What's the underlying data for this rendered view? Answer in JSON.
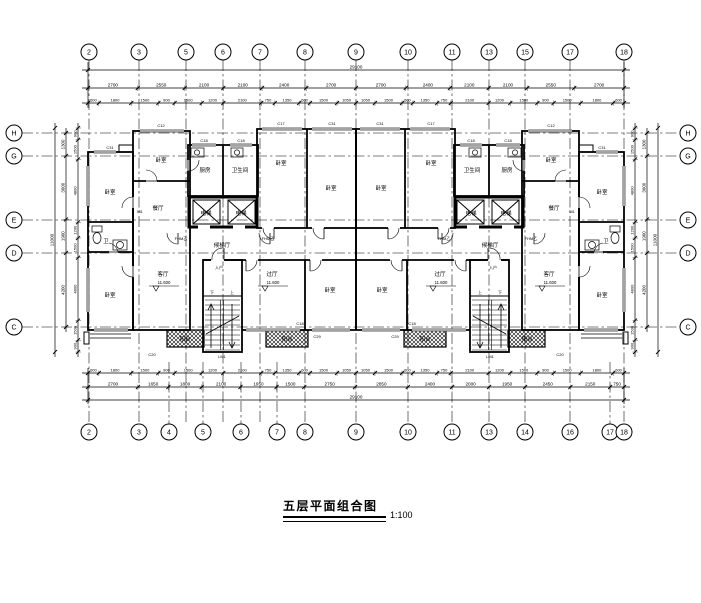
{
  "title": {
    "text": "五层平面组合图",
    "scale": "1:100"
  },
  "grids": {
    "top": {
      "y": 52,
      "x": [
        89,
        139,
        186,
        223,
        260,
        305,
        356,
        408,
        452,
        489,
        525,
        570,
        624
      ],
      "labels": [
        "2",
        "3",
        "5",
        "6",
        "7",
        "8",
        "9",
        "10",
        "11",
        "13",
        "15",
        "17",
        "18"
      ]
    },
    "bottom": {
      "y": 432,
      "x": [
        89,
        139,
        169,
        203,
        241,
        277,
        305,
        356,
        408,
        452,
        489,
        525,
        570,
        610,
        624
      ],
      "labels": [
        "2",
        "3",
        "4",
        "5",
        "6",
        "7",
        "8",
        "9",
        "10",
        "11",
        "13",
        "14",
        "16",
        "17",
        "18"
      ]
    },
    "left": {
      "x": 14,
      "y": [
        133,
        156,
        220,
        253,
        327
      ],
      "labels": [
        "H",
        "G",
        "E",
        "D",
        "C"
      ]
    },
    "right": {
      "x": 688,
      "y": [
        133,
        156,
        220,
        253,
        327
      ],
      "labels": [
        "H",
        "G",
        "E",
        "D",
        "C"
      ]
    }
  },
  "dimensions": {
    "top": {
      "overall": "29100",
      "axis": [
        "2700",
        "2550",
        "2100",
        "2100",
        "2400",
        "2700",
        "2700",
        "2400",
        "2100",
        "2100",
        "2550",
        "2700"
      ],
      "detail": [
        "600",
        "1800",
        "1500",
        "900",
        "1500",
        "1200",
        "2100",
        "750",
        "1350",
        "600",
        "1500",
        "1050",
        "1050",
        "1500",
        "600",
        "1350",
        "750",
        "2100",
        "1200",
        "1500",
        "900",
        "1500",
        "1800",
        "600"
      ]
    },
    "bottom": {
      "overall": "29100",
      "axis": [
        "2700",
        "1650",
        "1800",
        "2100",
        "1950",
        "1500",
        "2750",
        "2850",
        "2400",
        "2000",
        "1950",
        "2450",
        "2150",
        "750"
      ],
      "detail": [
        "600",
        "1800",
        "1500",
        "900",
        "1500",
        "1200",
        "2100",
        "750",
        "1350",
        "600",
        "1500",
        "1050",
        "1050",
        "1500",
        "600",
        "1350",
        "750",
        "2100",
        "1200",
        "1500",
        "900",
        "1500",
        "1800",
        "600"
      ]
    },
    "left": {
      "overall": "11000",
      "axis": [
        "1300",
        "3600",
        "1900",
        "4200"
      ],
      "detail": [
        "900",
        "1500",
        "4800",
        "1200",
        "1500",
        "4800",
        "1500",
        "900"
      ]
    },
    "right": {
      "overall": "11000",
      "axis": [
        "1300",
        "3600",
        "1900",
        "4200"
      ],
      "detail": [
        "900",
        "1500",
        "4800",
        "1200",
        "1500",
        "4800",
        "1500",
        "900"
      ]
    }
  },
  "plan": {
    "rooms": [
      {
        "t": "卧室",
        "x": 110,
        "y": 194
      },
      {
        "t": "卫",
        "x": 106,
        "y": 243
      },
      {
        "t": "卧室",
        "x": 110,
        "y": 297
      },
      {
        "t": "卧室",
        "x": 161,
        "y": 162
      },
      {
        "t": "餐厅",
        "x": 158,
        "y": 210
      },
      {
        "t": "厨房",
        "x": 205,
        "y": 172
      },
      {
        "t": "卫生间",
        "x": 240,
        "y": 172
      },
      {
        "t": "卧室",
        "x": 281,
        "y": 165
      },
      {
        "t": "卧室",
        "x": 331,
        "y": 190
      },
      {
        "t": "候梯厅",
        "x": 222,
        "y": 247
      },
      {
        "t": "卧室",
        "x": 330,
        "y": 292
      },
      {
        "t": "阳台",
        "x": 185,
        "y": 341
      },
      {
        "t": "阳台",
        "x": 287,
        "y": 341
      },
      {
        "t": "电梯",
        "x": 206,
        "y": 215
      },
      {
        "t": "电梯",
        "x": 241,
        "y": 215
      }
    ],
    "elevations": [
      {
        "t": "客厅",
        "v": "11.600",
        "x": 163,
        "y": 276
      },
      {
        "t": "过厅",
        "v": "11.600",
        "x": 272,
        "y": 276
      }
    ],
    "tags": [
      {
        "t": "C31",
        "x": 110,
        "y": 149
      },
      {
        "t": "C12",
        "x": 161,
        "y": 127
      },
      {
        "t": "C18",
        "x": 204,
        "y": 142
      },
      {
        "t": "C18",
        "x": 241,
        "y": 142
      },
      {
        "t": "C17",
        "x": 281,
        "y": 125
      },
      {
        "t": "C31",
        "x": 332,
        "y": 125
      },
      {
        "t": "M1",
        "x": 140,
        "y": 213
      },
      {
        "t": "FHM乙",
        "x": 181,
        "y": 240
      },
      {
        "t": "FHM乙",
        "x": 268,
        "y": 240
      },
      {
        "t": "入户",
        "x": 219,
        "y": 269
      },
      {
        "t": "下",
        "x": 212,
        "y": 294
      },
      {
        "t": "上",
        "x": 232,
        "y": 294
      },
      {
        "t": "C20",
        "x": 152,
        "y": 356
      },
      {
        "t": "LM1",
        "x": 222,
        "y": 358
      },
      {
        "t": "C29",
        "x": 317,
        "y": 338
      },
      {
        "t": "C18",
        "x": 300,
        "y": 325
      }
    ]
  }
}
